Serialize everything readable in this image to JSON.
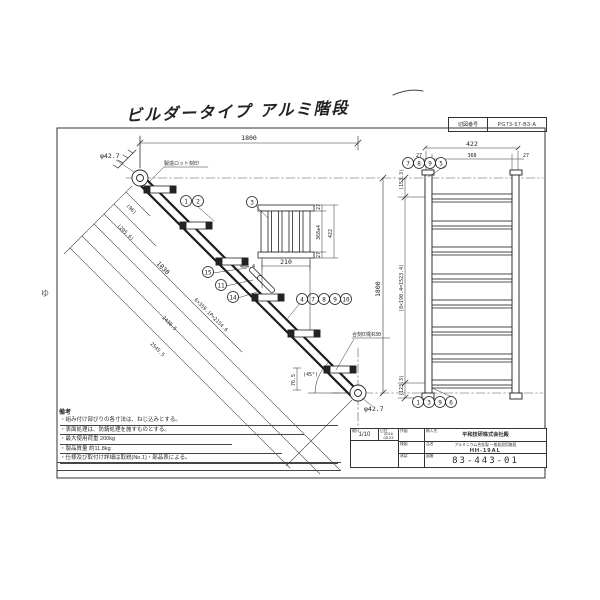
{
  "title": {
    "text": "ビルダータイプ アルミ階段"
  },
  "sheet": {
    "label": "切図番号",
    "value": "PG73-57-B3-A"
  },
  "margin": {
    "mark": "ゆ"
  },
  "side_view": {
    "dim_top": "1800",
    "dim_right": "1800",
    "dia_top": "φ42.7",
    "dia_bottom": "φ42.7",
    "note_lot": "製造ロット刻印",
    "note_mark": "合刻印彫R30",
    "angle": "(45°)",
    "dim_765": "76.5",
    "diag": [
      "(96)",
      "(205.6)",
      "1030",
      "6×359.1P=2154.6",
      "2430.5",
      "2545.5"
    ],
    "co_top": [
      "1",
      "2"
    ],
    "co_mid": [
      "15",
      "11",
      "14"
    ],
    "co_bot": [
      "4",
      "7",
      "8",
      "9",
      "10"
    ]
  },
  "tread_detail": {
    "callout": "3",
    "d27a": "27",
    "d368": "368±4",
    "d27b": "27",
    "d422": "422",
    "d210": "210",
    "d4644": "464.4"
  },
  "front_view": {
    "d422": "422",
    "d27l": "27",
    "d368": "368",
    "d27r": "27",
    "v153": "(153.3)",
    "v1523": "(8×190.4=1523.4)",
    "v123": "(123.3)",
    "co_top": [
      "7",
      "8",
      "9",
      "5"
    ],
    "co_bot": [
      "1",
      "3",
      "9",
      "6"
    ]
  },
  "notes": {
    "label": "備考",
    "items": [
      "・組み付け部びりの各寸法は、ねじ込みとする。",
      "・表面処理は、防錆処理を施すものとする。",
      "・最大使用荷重 200kg",
      "・製品質量 約11.8kg",
      "・仕様及び取付け詳細は取説(No.1)・部品表による。"
    ]
  },
  "title_block": {
    "scale_label": "縮尺",
    "scale": "1/10",
    "date_label": "日付",
    "date1": "2016",
    "date2": "05.23",
    "approvals": [
      "作図",
      "検図",
      "承認"
    ],
    "customer_label": "納入先",
    "customer": "平和技研株式会社殿",
    "product_label": "品名",
    "product": "アルミニウム合金製 一般仮設用階段",
    "model": "HH-19AL",
    "dwg_label": "図番",
    "dwg": "83-443-01"
  }
}
